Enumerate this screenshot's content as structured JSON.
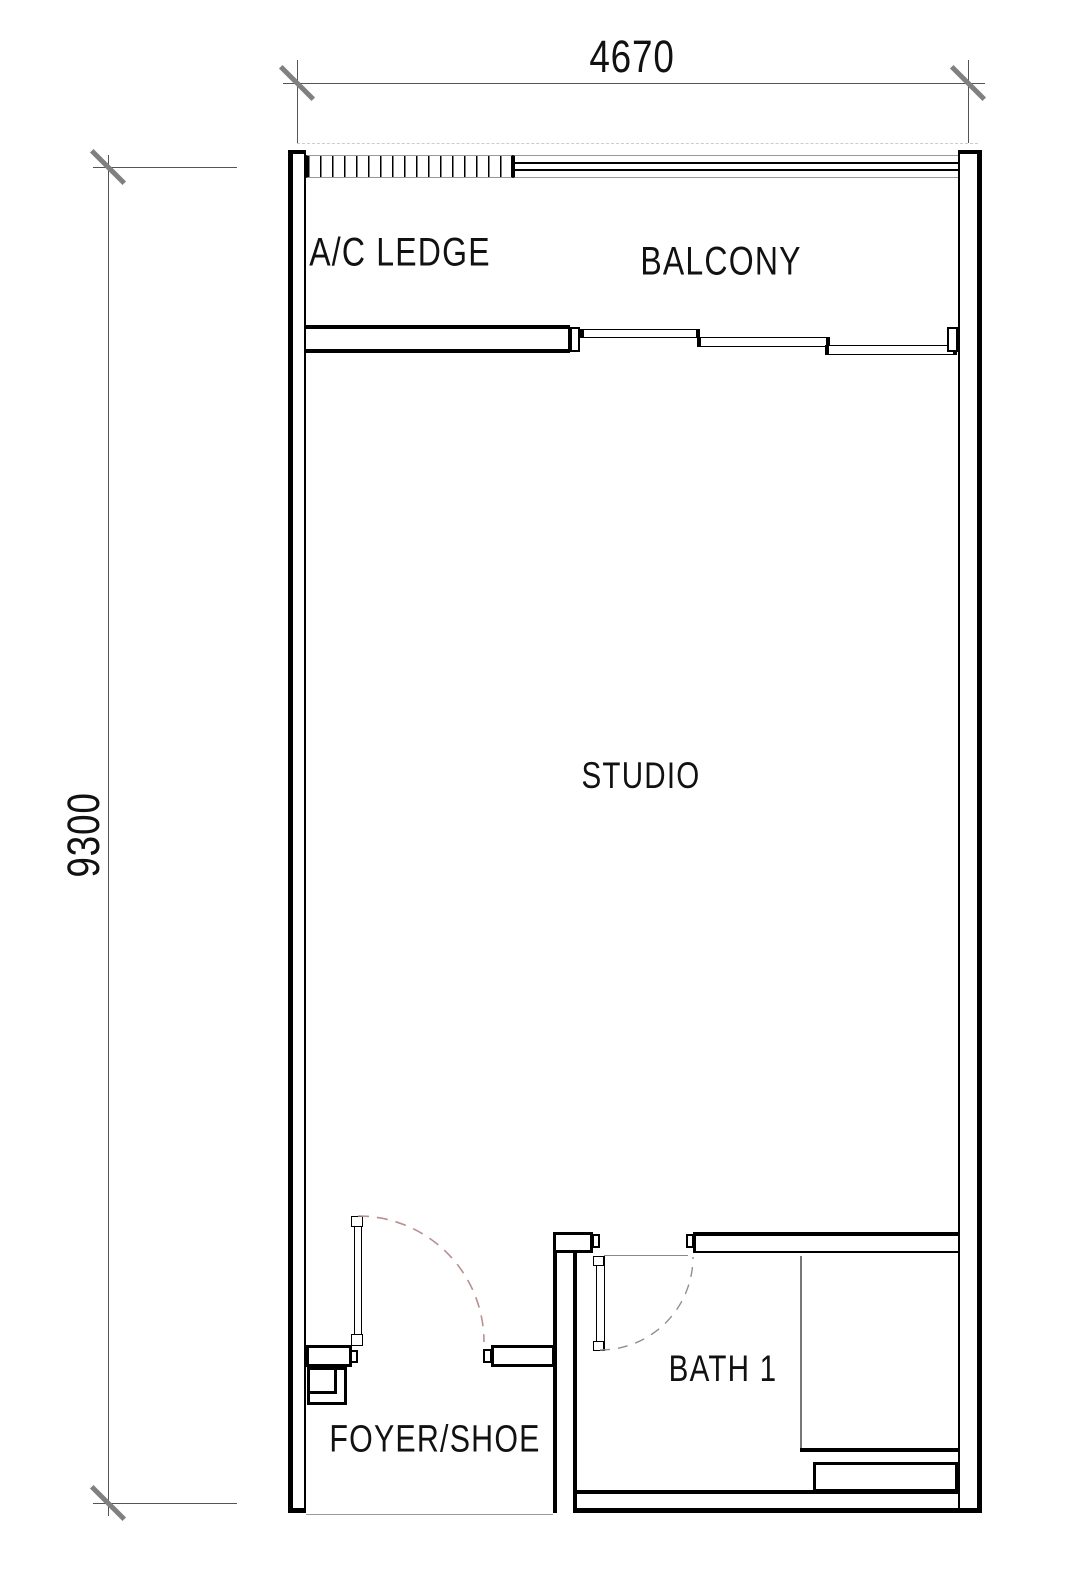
{
  "title": "Studio unit floor plan",
  "dimensions": {
    "width": "4670",
    "height": "9300"
  },
  "rooms": {
    "ac_ledge": "A/C LEDGE",
    "balcony": "BALCONY",
    "studio": "STUDIO",
    "bath": "BATH 1",
    "foyer": "FOYER/SHOE"
  },
  "colors": {
    "wall": "#000000",
    "dimension_tick": "#808080",
    "entry_door_arc": "#b98f8f",
    "bath_door_arc": "#909090"
  }
}
